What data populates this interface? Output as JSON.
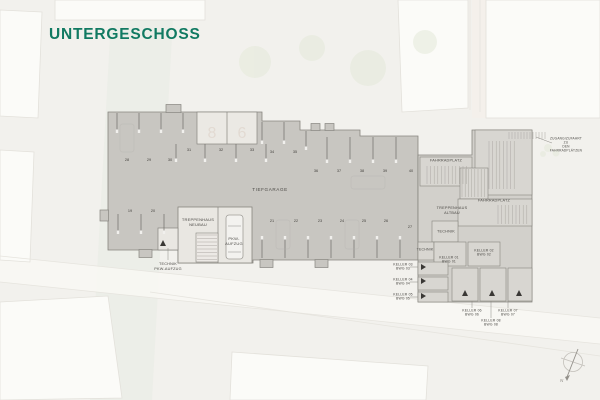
{
  "title": {
    "text": "UNTERGESCHOSS",
    "color": "#117a62"
  },
  "colors": {
    "background": "#f2f1ed",
    "garage_fill": "#c8c6c1",
    "altbau_fill": "#d2d0cb",
    "room_fill": "#d8d6d1",
    "wall": "#87857f",
    "label_text": "#4b4945"
  },
  "plan": {
    "area_label": "TIEFGARAGE",
    "compass_label": "N",
    "labels": [
      {
        "name": "label-tiefgarage",
        "text": "TIEFGARAGE",
        "x": 270,
        "y": 190,
        "size": 4.6,
        "ls": 0.6
      },
      {
        "name": "label-treppenhaus-neubau",
        "text": "TREPPENHAUS\nNEUBAU",
        "x": 198,
        "y": 222,
        "size": 4
      },
      {
        "name": "label-pkw-aufzug",
        "text": "PKW-\nAUFZUG",
        "x": 234,
        "y": 241,
        "size": 4
      },
      {
        "name": "label-technik-pkw-aufzug",
        "text": "TECHNIK\nPKW-AUFZUG",
        "x": 168,
        "y": 267,
        "size": 3.8
      },
      {
        "name": "label-fahrradplatz-1",
        "text": "FAHRRADPLATZ",
        "x": 446,
        "y": 161,
        "size": 3.8
      },
      {
        "name": "label-fahrradplatz-2",
        "text": "FAHRRADPLATZ",
        "x": 494,
        "y": 201,
        "size": 3.8
      },
      {
        "name": "label-treppenhaus-altbau",
        "text": "TREPPENHAUS\nALTBAU",
        "x": 452,
        "y": 211,
        "size": 3.8
      },
      {
        "name": "label-technik-1",
        "text": "TECHNIK",
        "x": 446,
        "y": 232,
        "size": 3.8
      },
      {
        "name": "label-technik-2",
        "text": "TECHNIK",
        "x": 425,
        "y": 250,
        "size": 3.5
      },
      {
        "name": "label-keller-01",
        "text": "KELLER 01\nBWG 01",
        "x": 449,
        "y": 260,
        "size": 3.4
      },
      {
        "name": "label-keller-02",
        "text": "KELLER 02\nBWG 02",
        "x": 484,
        "y": 253,
        "size": 3.4
      },
      {
        "name": "label-keller-03",
        "text": "KELLER 03\nBWG 03",
        "x": 403,
        "y": 267,
        "size": 3.4
      },
      {
        "name": "label-keller-04",
        "text": "KELLER 04\nBWG 04",
        "x": 403,
        "y": 282,
        "size": 3.4
      },
      {
        "name": "label-keller-05",
        "text": "KELLER 05\nBWG 05",
        "x": 403,
        "y": 297,
        "size": 3.4
      },
      {
        "name": "label-keller-06",
        "text": "KELLER 06\nBWG 06",
        "x": 472,
        "y": 313,
        "size": 3.4
      },
      {
        "name": "label-keller-07",
        "text": "KELLER 07\nBWG 07",
        "x": 508,
        "y": 313,
        "size": 3.4
      },
      {
        "name": "label-keller-08",
        "text": "KELLER 08\nBWG 08",
        "x": 491,
        "y": 323,
        "size": 3.4
      },
      {
        "name": "label-ramp-note",
        "text": "ZUGANG/ZUFAHRT ZU\nDEN FAHRRADPLÄTZEN",
        "x": 566,
        "y": 145,
        "size": 3.2
      }
    ],
    "parking_numbers": [
      {
        "label": "19",
        "x": 130,
        "y": 211
      },
      {
        "label": "20",
        "x": 153,
        "y": 211
      },
      {
        "label": "21",
        "x": 272,
        "y": 221
      },
      {
        "label": "22",
        "x": 296,
        "y": 221
      },
      {
        "label": "23",
        "x": 320,
        "y": 221
      },
      {
        "label": "24",
        "x": 342,
        "y": 221
      },
      {
        "label": "25",
        "x": 364,
        "y": 221
      },
      {
        "label": "26",
        "x": 386,
        "y": 221
      },
      {
        "label": "27",
        "x": 410,
        "y": 227
      },
      {
        "label": "28",
        "x": 127,
        "y": 160
      },
      {
        "label": "29",
        "x": 149,
        "y": 160
      },
      {
        "label": "30",
        "x": 170,
        "y": 160
      },
      {
        "label": "31",
        "x": 189,
        "y": 150
      },
      {
        "label": "32",
        "x": 221,
        "y": 150
      },
      {
        "label": "33",
        "x": 252,
        "y": 150
      },
      {
        "label": "34",
        "x": 272,
        "y": 152
      },
      {
        "label": "35",
        "x": 295,
        "y": 152
      },
      {
        "label": "36",
        "x": 316,
        "y": 171
      },
      {
        "label": "37",
        "x": 339,
        "y": 171
      },
      {
        "label": "38",
        "x": 362,
        "y": 171
      },
      {
        "label": "39",
        "x": 385,
        "y": 171
      },
      {
        "label": "40",
        "x": 411,
        "y": 171
      }
    ]
  }
}
